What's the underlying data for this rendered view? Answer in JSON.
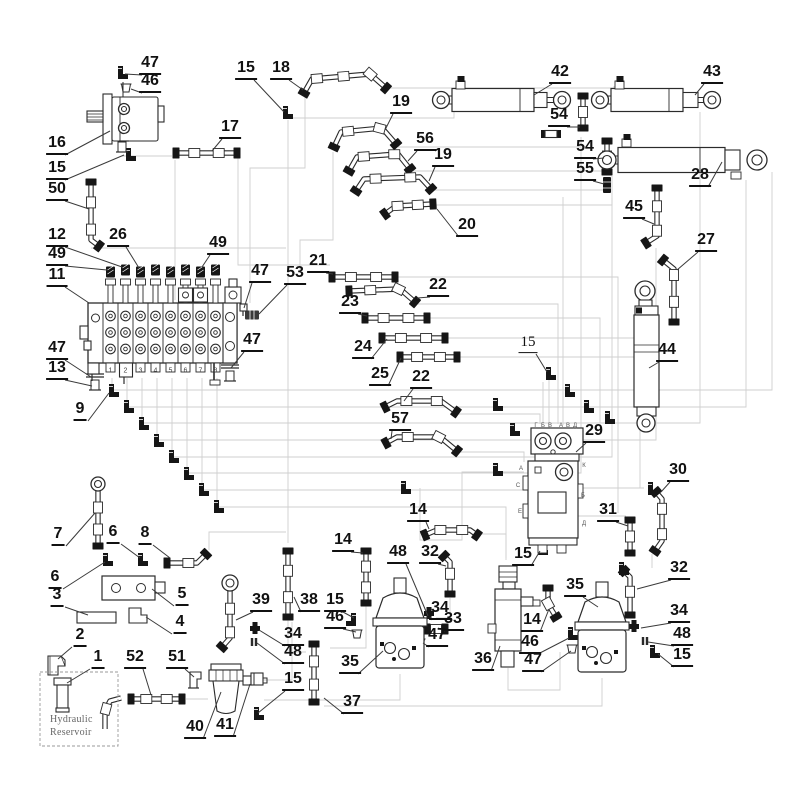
{
  "colors": {
    "outline": "#2b2b2b",
    "fitting": "#161616",
    "routing": "#cfcfcf",
    "leader": "#3a3a3a",
    "label": "#111111",
    "background": "#ffffff"
  },
  "diagram": {
    "reservoir": {
      "line1": "Hydraulic",
      "line2": "Reservoir"
    },
    "valve_ports": [
      "1",
      "2",
      "3",
      "4",
      "5",
      "6",
      "7",
      "8"
    ],
    "swivel_letters": [
      {
        "t": "Г",
        "x": 536,
        "y": 426
      },
      {
        "t": "Б",
        "x": 543,
        "y": 426
      },
      {
        "t": "В",
        "x": 550,
        "y": 426
      },
      {
        "t": "А",
        "x": 561,
        "y": 426
      },
      {
        "t": "В",
        "x": 568,
        "y": 426
      },
      {
        "t": "Д",
        "x": 575,
        "y": 426
      },
      {
        "t": "А",
        "x": 521,
        "y": 469
      },
      {
        "t": "К",
        "x": 584,
        "y": 466
      },
      {
        "t": "С",
        "x": 518,
        "y": 486
      },
      {
        "t": "Б",
        "x": 583,
        "y": 496
      },
      {
        "t": "Е",
        "x": 520,
        "y": 512
      },
      {
        "t": "Д",
        "x": 584,
        "y": 524
      }
    ],
    "callouts": [
      {
        "t": "47",
        "x": 150,
        "y": 66,
        "tx": 125,
        "ty": 74
      },
      {
        "t": "46",
        "x": 150,
        "y": 84,
        "tx": 131,
        "ty": 89
      },
      {
        "t": "16",
        "x": 57,
        "y": 146,
        "tx": 110,
        "ty": 131
      },
      {
        "t": "15",
        "x": 57,
        "y": 171,
        "tx": 124,
        "ty": 155
      },
      {
        "t": "50",
        "x": 57,
        "y": 192,
        "tx": 89,
        "ty": 209
      },
      {
        "t": "17",
        "x": 230,
        "y": 130,
        "tx": 212,
        "ty": 151
      },
      {
        "t": "15",
        "x": 246,
        "y": 71,
        "tx": 284,
        "ty": 112
      },
      {
        "t": "18",
        "x": 281,
        "y": 71,
        "tx": 303,
        "ty": 90
      },
      {
        "t": "19",
        "x": 401,
        "y": 105,
        "tx": 385,
        "ty": 130
      },
      {
        "t": "56",
        "x": 425,
        "y": 142,
        "tx": 408,
        "ty": 161
      },
      {
        "t": "19",
        "x": 443,
        "y": 158,
        "tx": 429,
        "ty": 181
      },
      {
        "t": "20",
        "x": 467,
        "y": 228,
        "tx": 437,
        "ty": 209
      },
      {
        "t": "42",
        "x": 560,
        "y": 75,
        "tx": 534,
        "ty": 95
      },
      {
        "t": "43",
        "x": 712,
        "y": 75,
        "tx": 695,
        "ty": 95
      },
      {
        "t": "54",
        "x": 559,
        "y": 118,
        "tx": 580,
        "ty": 127
      },
      {
        "t": "54",
        "x": 585,
        "y": 150,
        "tx": 604,
        "ty": 158
      },
      {
        "t": "55",
        "x": 585,
        "y": 172,
        "tx": 604,
        "ty": 184
      },
      {
        "t": "28",
        "x": 700,
        "y": 178,
        "tx": 722,
        "ty": 162
      },
      {
        "t": "45",
        "x": 634,
        "y": 210,
        "tx": 654,
        "ty": 224
      },
      {
        "t": "27",
        "x": 706,
        "y": 243,
        "tx": 677,
        "ty": 270
      },
      {
        "t": "44",
        "x": 667,
        "y": 353,
        "tx": 649,
        "ty": 368
      },
      {
        "t": "12",
        "x": 57,
        "y": 238,
        "tx": 122,
        "ty": 267
      },
      {
        "t": "49",
        "x": 57,
        "y": 257,
        "tx": 107,
        "ty": 270
      },
      {
        "t": "26",
        "x": 118,
        "y": 238,
        "tx": 139,
        "ty": 268
      },
      {
        "t": "49",
        "x": 218,
        "y": 246,
        "tx": 202,
        "ty": 267
      },
      {
        "t": "11",
        "x": 57,
        "y": 278,
        "tx": 89,
        "ty": 303
      },
      {
        "t": "47",
        "x": 260,
        "y": 274,
        "tx": 244,
        "ty": 308
      },
      {
        "t": "53",
        "x": 295,
        "y": 276,
        "tx": 259,
        "ty": 314
      },
      {
        "t": "21",
        "x": 318,
        "y": 264,
        "tx": 333,
        "ty": 274
      },
      {
        "t": "22",
        "x": 438,
        "y": 288,
        "tx": 417,
        "ty": 298
      },
      {
        "t": "23",
        "x": 350,
        "y": 305,
        "tx": 367,
        "ty": 316
      },
      {
        "t": "24",
        "x": 363,
        "y": 350,
        "tx": 387,
        "ty": 339
      },
      {
        "t": "25",
        "x": 380,
        "y": 377,
        "tx": 401,
        "ty": 358
      },
      {
        "t": "22",
        "x": 421,
        "y": 380,
        "tx": 404,
        "ty": 401
      },
      {
        "t": "57",
        "x": 400,
        "y": 422,
        "tx": 391,
        "ty": 439
      },
      {
        "t": "47",
        "x": 57,
        "y": 351,
        "tx": 91,
        "ty": 377
      },
      {
        "t": "13",
        "x": 57,
        "y": 371,
        "tx": 92,
        "ty": 386
      },
      {
        "t": "9",
        "x": 80,
        "y": 412,
        "tx": 109,
        "ty": 393
      },
      {
        "t": "47",
        "x": 252,
        "y": 343,
        "tx": 231,
        "ty": 368
      },
      {
        "t": "15",
        "x": 528,
        "y": 345,
        "tx": 547,
        "ty": 372,
        "light": true
      },
      {
        "t": "29",
        "x": 594,
        "y": 434,
        "tx": 576,
        "ty": 452
      },
      {
        "t": "30",
        "x": 678,
        "y": 473,
        "tx": 661,
        "ty": 492
      },
      {
        "t": "31",
        "x": 608,
        "y": 513,
        "tx": 628,
        "ty": 526
      },
      {
        "t": "32",
        "x": 679,
        "y": 571,
        "tx": 637,
        "ty": 589
      },
      {
        "t": "34",
        "x": 679,
        "y": 614,
        "tx": 641,
        "ty": 628
      },
      {
        "t": "48",
        "x": 682,
        "y": 637,
        "tx": 648,
        "ty": 642
      },
      {
        "t": "15",
        "x": 682,
        "y": 658,
        "tx": 658,
        "ty": 654
      },
      {
        "t": "7",
        "x": 58,
        "y": 537,
        "tx": 95,
        "ty": 513
      },
      {
        "t": "6",
        "x": 113,
        "y": 535,
        "tx": 140,
        "ty": 558
      },
      {
        "t": "8",
        "x": 145,
        "y": 536,
        "tx": 170,
        "ty": 558
      },
      {
        "t": "6",
        "x": 55,
        "y": 580,
        "tx": 105,
        "ty": 562
      },
      {
        "t": "3",
        "x": 57,
        "y": 598,
        "tx": 88,
        "ty": 615
      },
      {
        "t": "5",
        "x": 182,
        "y": 597,
        "tx": 152,
        "ty": 589
      },
      {
        "t": "4",
        "x": 180,
        "y": 625,
        "tx": 146,
        "ty": 617
      },
      {
        "t": "2",
        "x": 80,
        "y": 638,
        "tx": 58,
        "ty": 659
      },
      {
        "t": "1",
        "x": 98,
        "y": 660,
        "tx": 67,
        "ty": 683
      },
      {
        "t": "52",
        "x": 135,
        "y": 660,
        "tx": 151,
        "ty": 695
      },
      {
        "t": "51",
        "x": 177,
        "y": 660,
        "tx": 194,
        "ty": 677
      },
      {
        "t": "39",
        "x": 261,
        "y": 603,
        "tx": 236,
        "ty": 620
      },
      {
        "t": "38",
        "x": 309,
        "y": 603,
        "tx": 294,
        "ty": 597
      },
      {
        "t": "15",
        "x": 335,
        "y": 603,
        "tx": 354,
        "ty": 618
      },
      {
        "t": "46",
        "x": 335,
        "y": 620,
        "tx": 356,
        "ty": 632
      },
      {
        "t": "34",
        "x": 293,
        "y": 637,
        "tx": 259,
        "ty": 630
      },
      {
        "t": "48",
        "x": 293,
        "y": 655,
        "tx": 257,
        "ty": 643
      },
      {
        "t": "14",
        "x": 418,
        "y": 513,
        "tx": 429,
        "ty": 529
      },
      {
        "t": "14",
        "x": 343,
        "y": 543,
        "tx": 363,
        "ty": 553
      },
      {
        "t": "48",
        "x": 398,
        "y": 555,
        "tx": 428,
        "ty": 616
      },
      {
        "t": "32",
        "x": 430,
        "y": 555,
        "tx": 446,
        "ty": 566
      },
      {
        "t": "34",
        "x": 440,
        "y": 611,
        "tx": 430,
        "ty": 617
      },
      {
        "t": "33",
        "x": 453,
        "y": 622,
        "tx": 438,
        "ty": 628
      },
      {
        "t": "47",
        "x": 437,
        "y": 638,
        "tx": 423,
        "ty": 643
      },
      {
        "t": "36",
        "x": 483,
        "y": 662,
        "tx": 500,
        "ty": 646
      },
      {
        "t": "35",
        "x": 350,
        "y": 665,
        "tx": 383,
        "ty": 651
      },
      {
        "t": "35",
        "x": 575,
        "y": 588,
        "tx": 598,
        "ty": 607
      },
      {
        "t": "14",
        "x": 532,
        "y": 623,
        "tx": 549,
        "ty": 609
      },
      {
        "t": "46",
        "x": 530,
        "y": 645,
        "tx": 569,
        "ty": 638
      },
      {
        "t": "47",
        "x": 533,
        "y": 663,
        "tx": 571,
        "ty": 651
      },
      {
        "t": "37",
        "x": 352,
        "y": 705,
        "tx": 324,
        "ty": 698
      },
      {
        "t": "40",
        "x": 195,
        "y": 730,
        "tx": 221,
        "ty": 692
      },
      {
        "t": "41",
        "x": 225,
        "y": 728,
        "tx": 250,
        "ty": 684
      },
      {
        "t": "15",
        "x": 293,
        "y": 682,
        "tx": 258,
        "ty": 713
      },
      {
        "t": "15",
        "x": 523,
        "y": 557,
        "tx": 540,
        "ty": 551
      }
    ]
  }
}
